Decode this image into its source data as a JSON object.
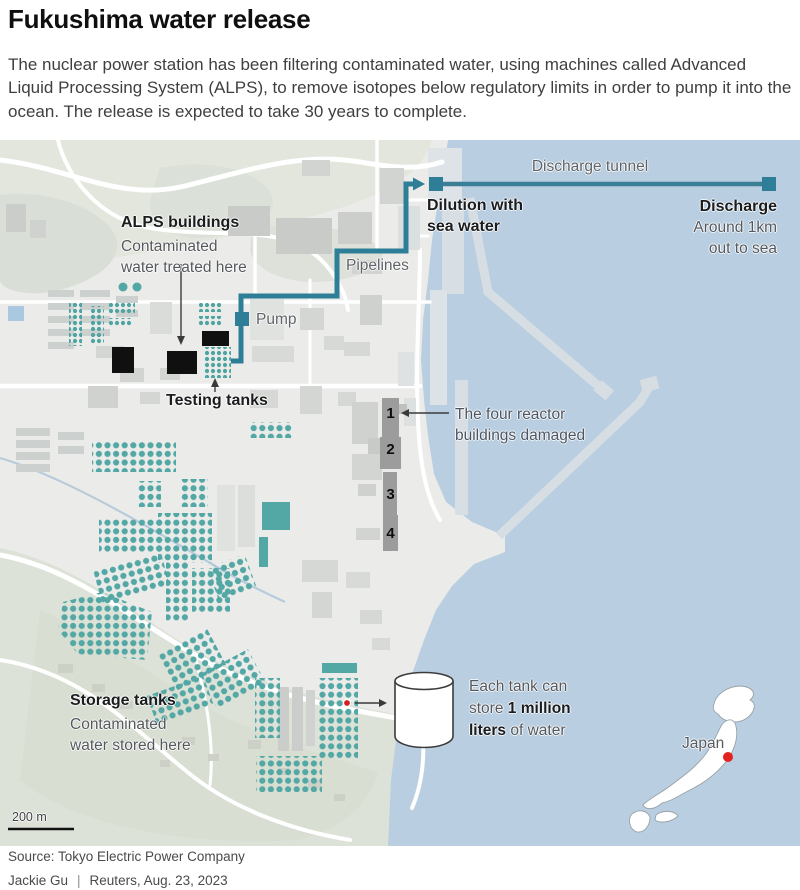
{
  "header": {
    "title": "Fukushima water release",
    "intro": "The nuclear power station has been filtering contaminated water, using machines called Advanced Liquid Processing System (ALPS), to remove isotopes below regulatory limits in order to pump it into the ocean. The release is expected to take 30 years to complete."
  },
  "map": {
    "discharge_tunnel_label": "Discharge tunnel",
    "dilution_label": [
      "Dilution with",
      "sea water"
    ],
    "discharge_label": "Discharge",
    "discharge_sub": [
      "Around 1km",
      "out to sea"
    ],
    "pipelines_label": "Pipelines",
    "pump_label": "Pump",
    "alps_label": "ALPS buildings",
    "alps_sub": [
      "Contaminated",
      "water treated here"
    ],
    "testing_tanks_label": "Testing tanks",
    "reactor_note": [
      "The four reactor",
      "buildings damaged"
    ],
    "reactor_numbers": [
      "1",
      "2",
      "3",
      "4"
    ],
    "storage_label": "Storage tanks",
    "storage_sub": [
      "Contaminated",
      "water stored here"
    ],
    "tank_note": {
      "line1": "Each tank can",
      "line2_pre": "store ",
      "line2_bold": "1 million",
      "line3_bold": "liters",
      "line3_post": " of water"
    },
    "japan_label": "Japan",
    "scale_label": "200 m",
    "colors": {
      "sea": "#b9cfe1",
      "land": "#ebecea",
      "pipeline_teal": "#2d7e96",
      "tank_teal": "#53a7a4",
      "reactor_gray": "#9c9c9c",
      "alps_black": "#101010",
      "marker_red": "#d6201f"
    }
  },
  "footer": {
    "source": "Source: Tokyo Electric Power Company",
    "byline": "Jackie Gu",
    "separator": "|",
    "date": "Reuters, Aug. 23, 2023"
  }
}
